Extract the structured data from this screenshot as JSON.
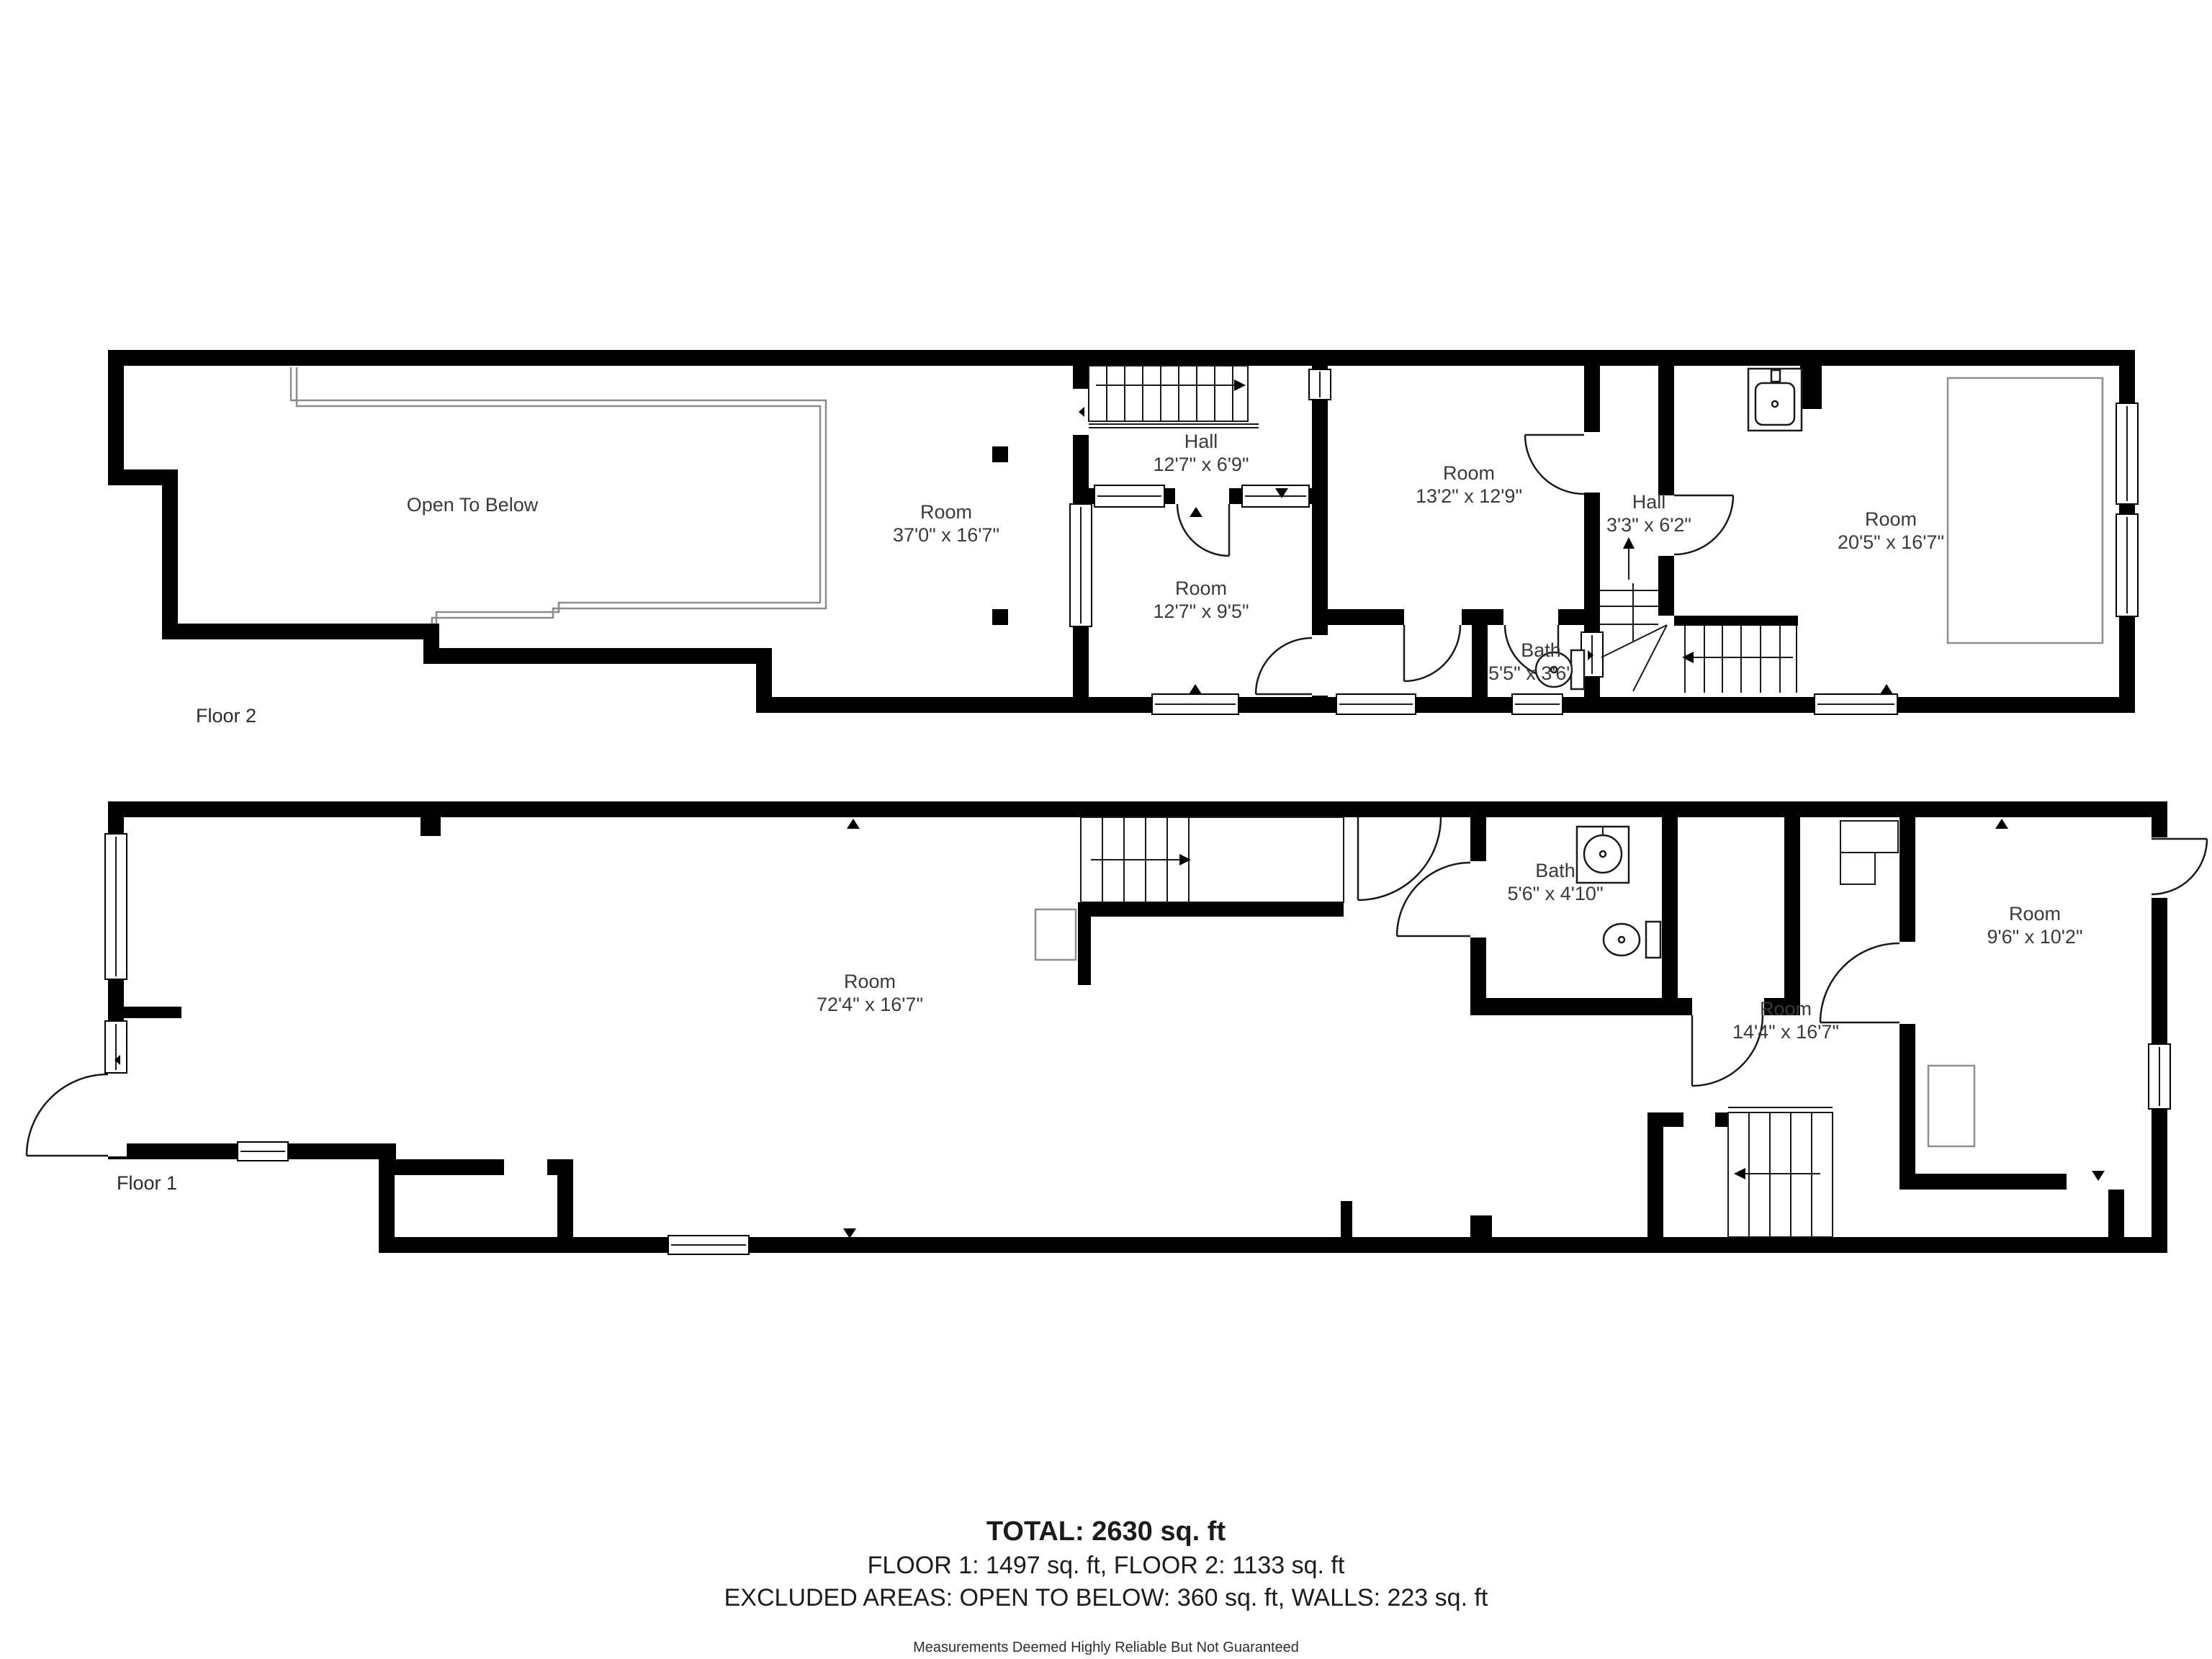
{
  "floor2": {
    "label": "Floor 2",
    "open_to_below": "Open To Below",
    "room_370": {
      "name": "Room",
      "dims": "37'0\" x 16'7\""
    },
    "hall_127": {
      "name": "Hall",
      "dims": "12'7\" x 6'9\""
    },
    "room_127": {
      "name": "Room",
      "dims": "12'7\" x 9'5\""
    },
    "room_132": {
      "name": "Room",
      "dims": "13'2\" x 12'9\""
    },
    "hall_33": {
      "name": "Hall",
      "dims": "3'3\" x 6'2\""
    },
    "bath_55": {
      "name": "Bath",
      "dims": "5'5\" x 3'6\""
    },
    "room_205": {
      "name": "Room",
      "dims": "20'5\" x 16'7\""
    }
  },
  "floor1": {
    "label": "Floor 1",
    "room_724": {
      "name": "Room",
      "dims": "72'4\" x 16'7\""
    },
    "bath_56": {
      "name": "Bath",
      "dims": "5'6\" x 4'10\""
    },
    "room_144": {
      "name": "Room",
      "dims": "14'4\" x 16'7\""
    },
    "room_96": {
      "name": "Room",
      "dims": "9'6\" x 10'2\""
    }
  },
  "summary": {
    "total": "TOTAL: 2630 sq. ft",
    "floors": "FLOOR 1: 1497 sq. ft, FLOOR 2: 1133 sq. ft",
    "excluded": "EXCLUDED AREAS: OPEN TO BELOW: 360 sq. ft, WALLS: 223 sq. ft",
    "disclaimer": "Measurements Deemed Highly Reliable But Not Guaranteed"
  }
}
